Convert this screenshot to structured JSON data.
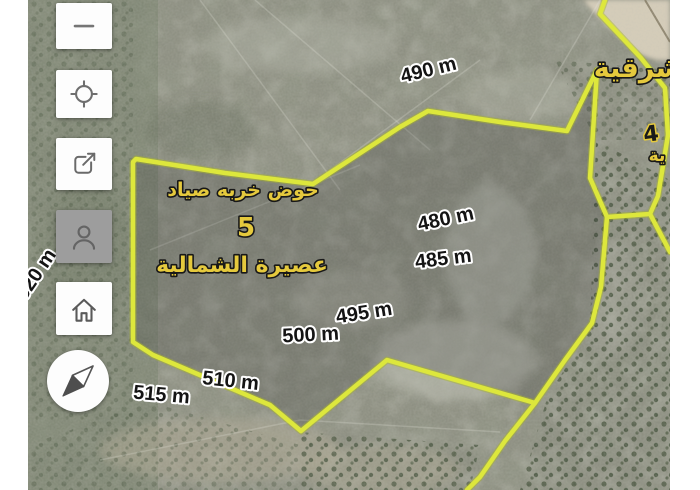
{
  "app": {
    "type": "satellite-parcel-map-viewer"
  },
  "toolbar": {
    "buttons": [
      {
        "id": "zoom-out",
        "icon": "minus-icon"
      },
      {
        "id": "locate",
        "icon": "crosshair-icon"
      },
      {
        "id": "share",
        "icon": "share-icon"
      },
      {
        "id": "profile",
        "icon": "person-icon"
      },
      {
        "id": "home",
        "icon": "home-icon"
      },
      {
        "id": "compass",
        "icon": "compass-icon"
      }
    ]
  },
  "map": {
    "parcel": {
      "basin_title": "حوض خربه صياد",
      "basin_number": "5",
      "town_name": "عصيرة الشمالية"
    },
    "neighbor_labels": {
      "top_right": "شرقية",
      "right_edge_number": "4",
      "right_edge_fragment": "ية"
    },
    "elevation_labels": [
      {
        "text": "490 m"
      },
      {
        "text": "480 m"
      },
      {
        "text": "485 m"
      },
      {
        "text": "495 m"
      },
      {
        "text": "500 m"
      },
      {
        "text": "510 m"
      },
      {
        "text": "515 m"
      },
      {
        "text": "520 m"
      }
    ],
    "colors": {
      "boundary_yellow": "#dde73c",
      "boundary_glow": "#aab726",
      "label_gold": "#e5c93d",
      "elevation_text": "#141414",
      "elevation_outline": "#ffffff"
    }
  }
}
